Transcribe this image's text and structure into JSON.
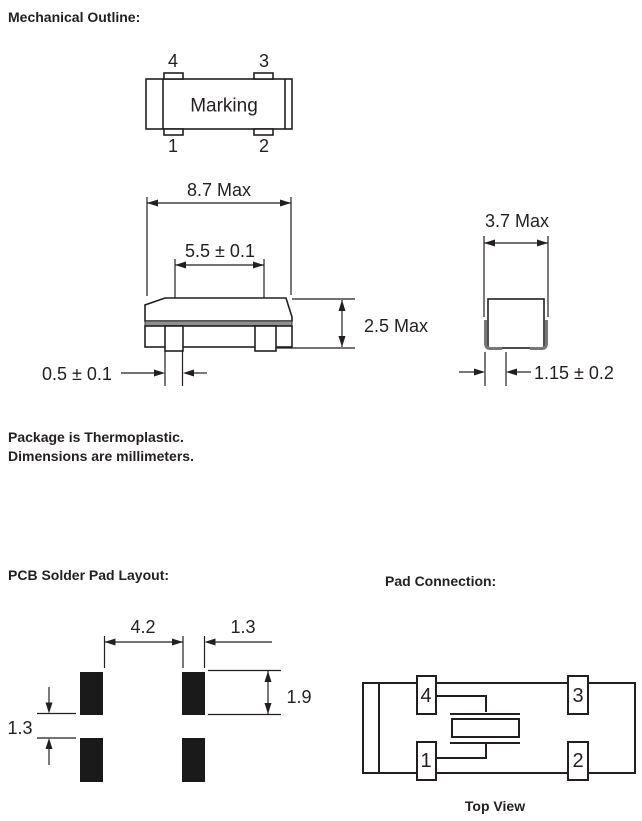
{
  "page": {
    "colors": {
      "ink": "#231f20",
      "pad": "#1a1a1a",
      "seam": "#8f8f8f",
      "lead": "#777777",
      "paper": "#ffffff"
    }
  },
  "sections": {
    "mechanical_outline": {
      "heading": "Mechanical Outline:",
      "package_top_view": {
        "marking": "Marking",
        "pin_labels": {
          "p4": "4",
          "p3": "3",
          "p1": "1",
          "p2": "2"
        }
      },
      "dimensions": {
        "body_length": "8.7 Max",
        "lead_spacing": "5.5 ± 0.1",
        "height": "2.5 Max",
        "lead_width": "0.5 ± 0.1",
        "body_width": "3.7 Max",
        "end_lead_width": "1.15 ± 0.2"
      },
      "notes": {
        "line1": "Package is Thermoplastic.",
        "line2": "Dimensions are millimeters."
      }
    },
    "pcb_solder_pad_layout": {
      "heading": "PCB Solder Pad Layout:",
      "dimensions": {
        "pad_span": "4.2",
        "pad_width": "1.3",
        "pad_height": "1.9",
        "pad_gap": "1.3"
      }
    },
    "pad_connection": {
      "heading": "Pad Connection:",
      "pad_labels": {
        "p4": "4",
        "p3": "3",
        "p1": "1",
        "p2": "2"
      },
      "caption": "Top View"
    }
  }
}
